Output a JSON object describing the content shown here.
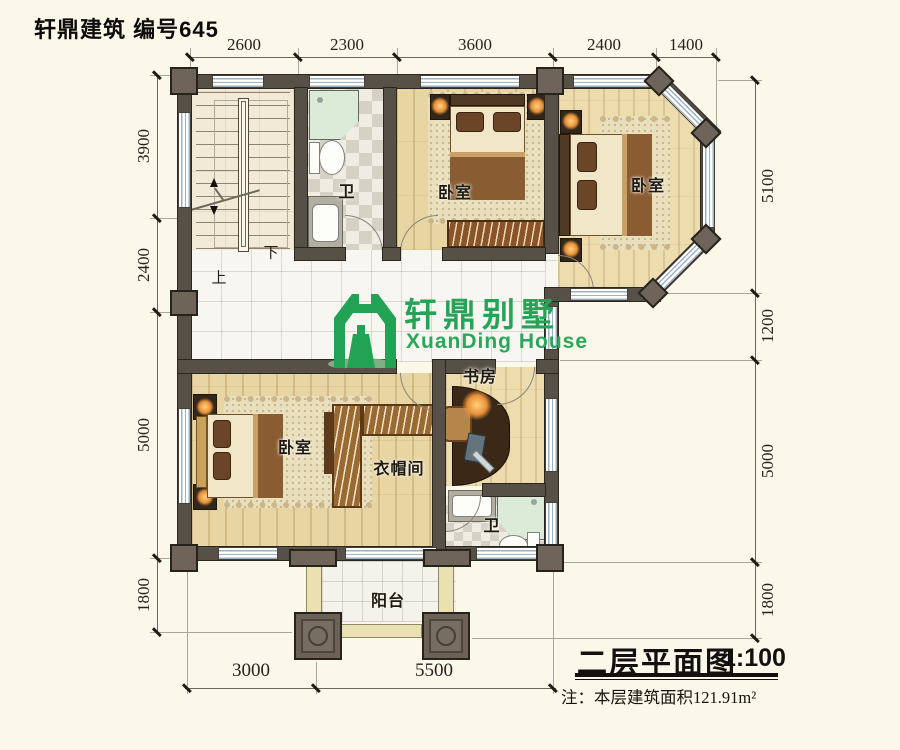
{
  "header": {
    "title": "轩鼎建筑 编号645"
  },
  "logo": {
    "cn": "轩鼎别墅",
    "en": "XuanDing House",
    "green": "#21a254"
  },
  "stair": {
    "up": "上",
    "down": "下"
  },
  "rooms": {
    "bath_top": "卫",
    "bedroom_top": "卧室",
    "bedroom_right": "卧室",
    "bedroom_lower": "卧室",
    "cloakroom": "衣帽间",
    "study": "书房",
    "bath_lower": "卫",
    "balcony": "阳台"
  },
  "dims": {
    "top": [
      "2600",
      "2300",
      "3600",
      "2400",
      "1400"
    ],
    "left": [
      "3900",
      "2400",
      "5000",
      "1800"
    ],
    "right": [
      "5100",
      "1200",
      "5000",
      "1800"
    ],
    "bottom": [
      "3000",
      "5500"
    ]
  },
  "titleblock": {
    "name": "二层平面图",
    "scale": "1:100",
    "note": "注：本层建筑面积121.91m²"
  },
  "colors": {
    "wall": "#575046",
    "wood": "#e7d5a3",
    "logo_green": "#21a254"
  }
}
